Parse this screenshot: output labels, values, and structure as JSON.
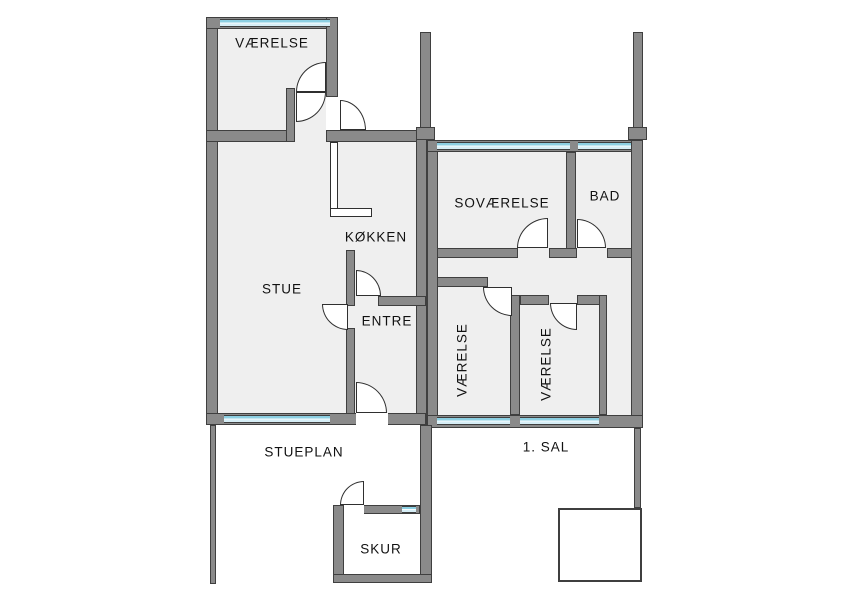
{
  "title": "Floor plan",
  "colors": {
    "wall_fill": "#8a8a8a",
    "wall_edge": "#3f3f3f",
    "room_fill": "#efefef",
    "window_blue": "#8ccfe2",
    "window_blue_light": "#d6eef6",
    "background": "#ffffff",
    "text": "#111111"
  },
  "floors": {
    "ground": {
      "name": "STUEPLAN",
      "rooms": {
        "vaerelse": "VÆRELSE",
        "stue": "STUE",
        "kokken": "KØKKEN",
        "entre": "ENTRE"
      },
      "shed": "SKUR"
    },
    "first": {
      "name": "1. SAL",
      "rooms": {
        "sovaerelse": "SOVÆRELSE",
        "bad": "BAD",
        "vaerelse_a": "VÆRELSE",
        "vaerelse_b": "VÆRELSE"
      }
    }
  }
}
